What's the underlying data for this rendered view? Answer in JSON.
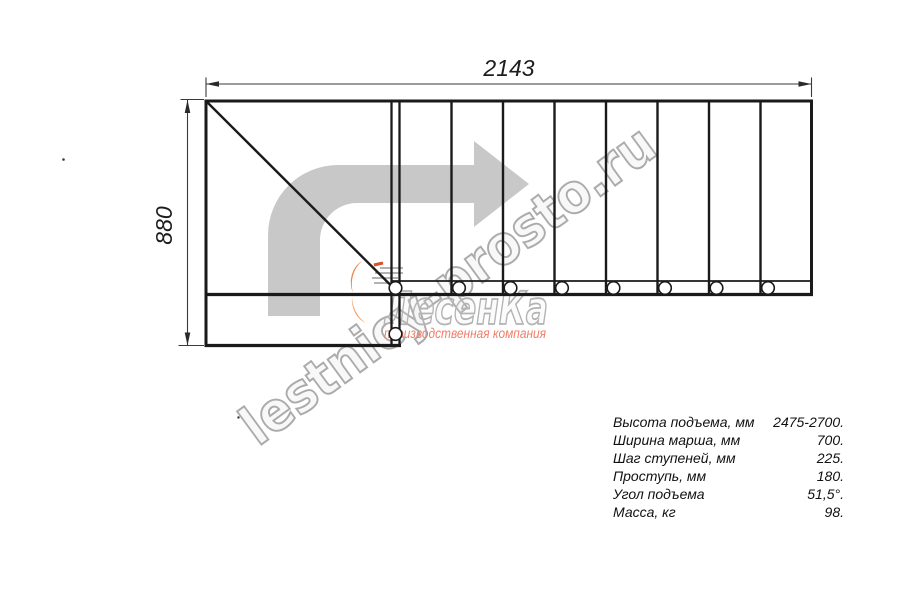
{
  "drawing": {
    "width_dimension": "2143",
    "height_dimension": "880",
    "line_color": "#1a1a1a",
    "arrow_color": "#c8c8c8"
  },
  "watermark": {
    "site_text": "lestnicy-prosto.ru",
    "logo_text": "ЛесенКа",
    "logo_subtext": "производственная компания",
    "text_color": "#ababab",
    "flame_color": "#ef7f42",
    "subtext_color": "#ee7e6b"
  },
  "specs": {
    "rows": [
      {
        "label": "Высота подъема, мм",
        "value": "2475-2700."
      },
      {
        "label": "Ширина марша, мм",
        "value": "700."
      },
      {
        "label": "Шаг ступеней, мм",
        "value": "225."
      },
      {
        "label": "Проступь, мм",
        "value": "180."
      },
      {
        "label": "Угол подъема",
        "value": "51,5°."
      },
      {
        "label": "Масса, кг",
        "value": "98."
      }
    ]
  }
}
